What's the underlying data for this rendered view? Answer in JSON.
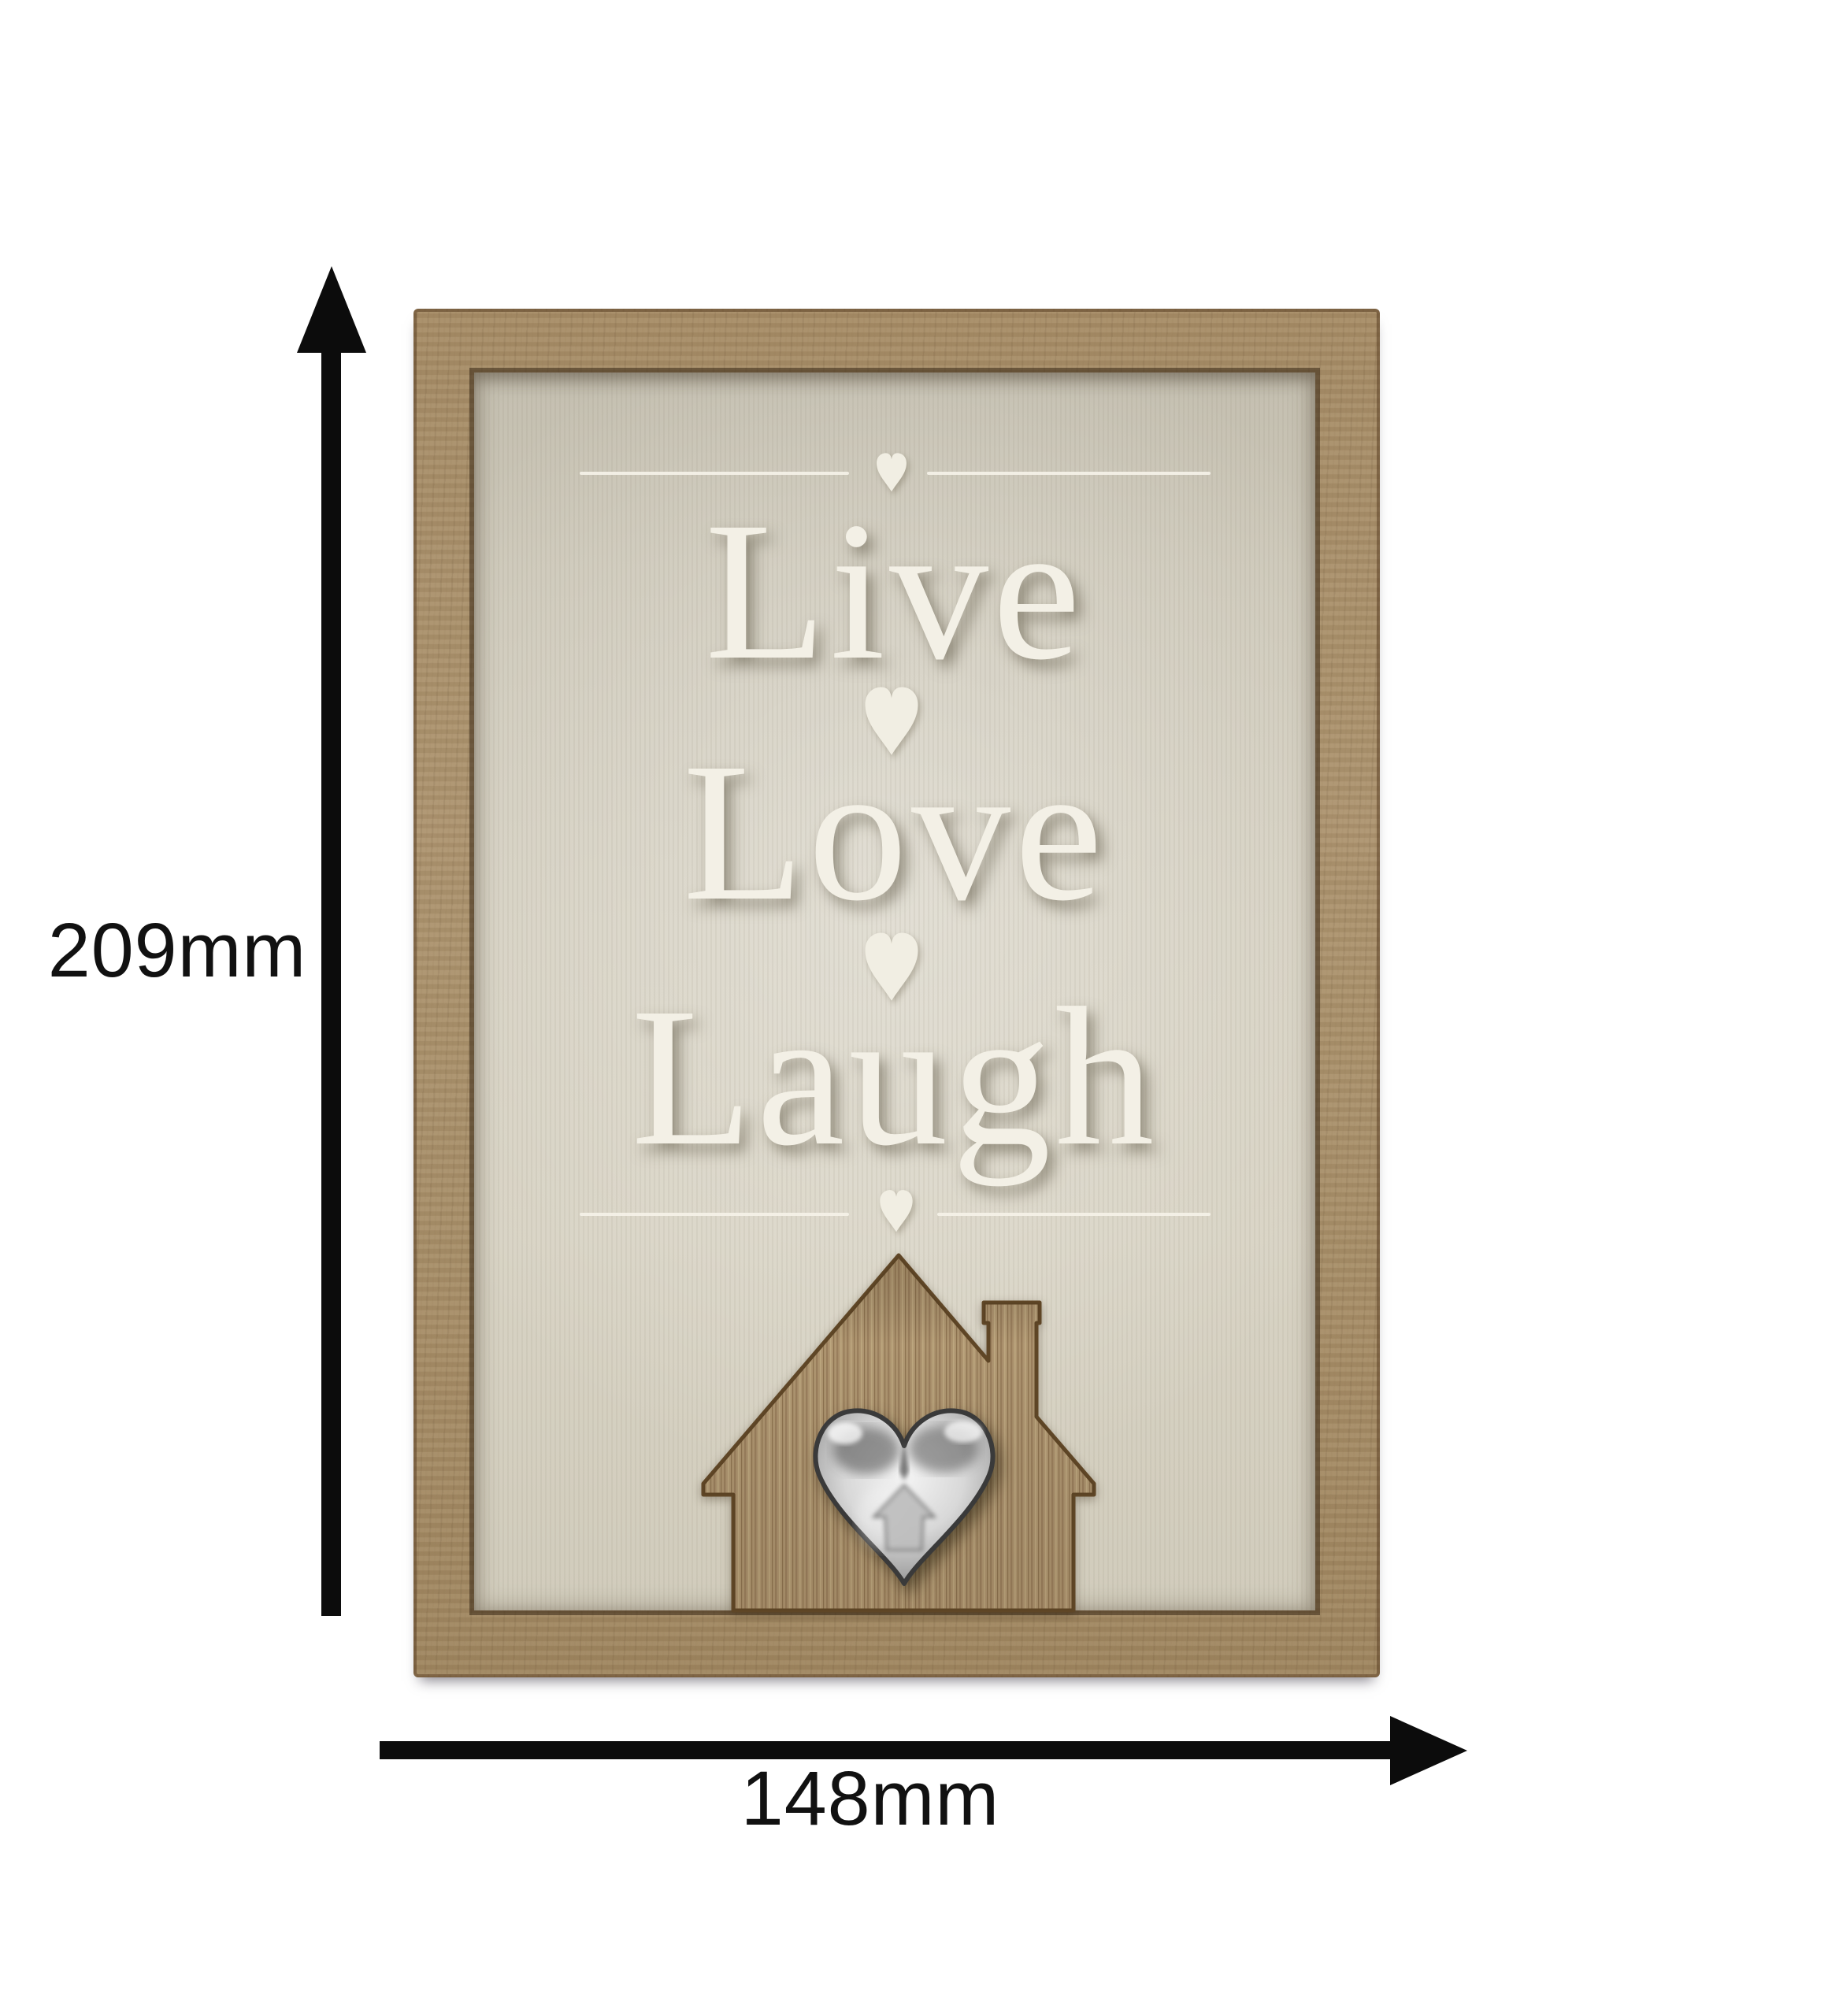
{
  "plaque": {
    "words": [
      "Live",
      "Love",
      "Laugh"
    ],
    "text_color": "#f3f0e6",
    "wood_color": "#a78e68",
    "panel_color": "#d5d0c1",
    "divider_heart_color": "#f1eee3",
    "silver_heart_color": "#c0c0c0"
  },
  "dimensions": {
    "height": "209mm",
    "width": "148mm",
    "arrow_color": "#0c0c0c"
  },
  "icons": {
    "top_divider": "heart-icon",
    "between_live_love": "heart-icon",
    "between_love_laugh": "heart-icon",
    "bottom_divider": "heart-icon",
    "house": "house-silhouette-icon",
    "center_emblem": "metal-heart-icon",
    "vertical_measure": "up-arrow-icon",
    "horizontal_measure": "right-arrow-icon"
  }
}
